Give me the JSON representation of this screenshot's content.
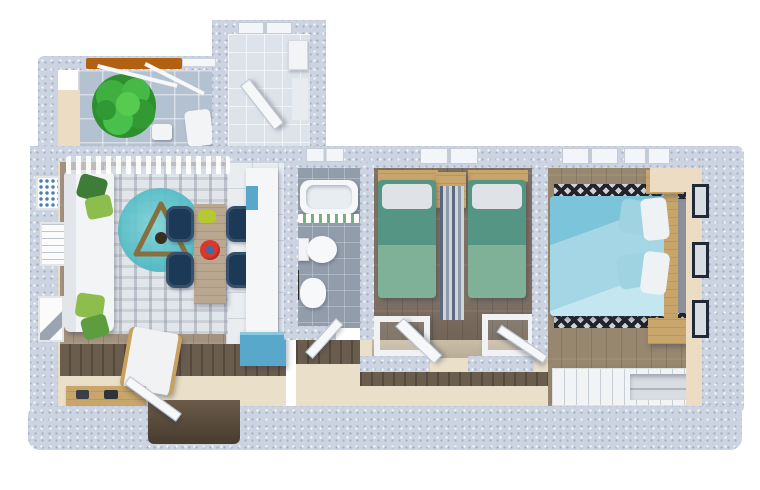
{
  "scene": {
    "type": "3d-floor-plan-render",
    "view": "top-down cutaway",
    "text_labels": [],
    "counts": {
      "dining_chairs": 4,
      "twin_beds": 2,
      "living_wall_frames": 3,
      "master_wall_frames": 3,
      "master_nightstands": 2,
      "desks": 2,
      "balcony_trees": 1
    }
  },
  "palette": {
    "wall_outer": "#ccd4e1",
    "wall_face": "#eddcc4",
    "balcony_tile": "#b4c1d1",
    "tile_light": "#dde3ea",
    "tile_kitchen": "#e9edf0",
    "tile_bath": "#929dab",
    "wood_living": "#a3927e",
    "wood_dark": "#7e7164",
    "wood_master": "#97876f",
    "wood_band": "#6b5d4e",
    "wood_furniture": "#c8a56a",
    "hall_floor": "#eadfc8",
    "rug_base": "#e2e5e9",
    "rug_round_teal": "#54bdc6",
    "rug_master": "#8d9197",
    "zigzag_dark": "#21252b",
    "sofa_white": "#f3f4f5",
    "pillow": "#dfe3e8",
    "pillow_green_dark": "#3e7d37",
    "pillow_green_light": "#8cbd4d",
    "bed_green": "#549683",
    "bed_green_light": "#7fb199",
    "bed_blue": "#a4d6e6",
    "bed_blue_deep": "#7cc4da",
    "chair_navy": "#1c3a58",
    "counter_blue": "#58a8cc",
    "rail_orange": "#b26012",
    "tree_green": "#3faf3f",
    "accent_red": "#d8382e",
    "frame_navy": "#1e2a38",
    "void_dark": "#473c2f"
  },
  "rooms": [
    {
      "id": "balcony",
      "objects": [
        "potted-tree",
        "tile-floor",
        "orange-rail",
        "pergola-beams",
        "outdoor-chair"
      ]
    },
    {
      "id": "utility-room",
      "objects": [
        "window",
        "open-door",
        "washer-unit",
        "shelf",
        "tile-floor"
      ]
    },
    {
      "id": "living-dining-kitchen",
      "objects": [
        "sofa",
        "green-cushions",
        "area-rug",
        "round-teal-rug",
        "triangle-decor",
        "wall-frames",
        "dining-table",
        "dining-chairs",
        "red-plate",
        "green-dish",
        "lounge-chair",
        "kitchen-counter",
        "blue-cabinet",
        "shoe-bench",
        "shoes",
        "curtained-window",
        "entry-door",
        "entry-opening"
      ]
    },
    {
      "id": "bathroom",
      "objects": [
        "bathtub",
        "shower-curtain",
        "toilet",
        "bidet",
        "towel-rail",
        "window",
        "door"
      ]
    },
    {
      "id": "bedroom-twin",
      "objects": [
        "single-bed-left",
        "single-bed-right",
        "headboards",
        "nightstand",
        "striped-runner",
        "desk-left",
        "desk-right",
        "window",
        "open-door"
      ]
    },
    {
      "id": "bedroom-master",
      "objects": [
        "double-bed",
        "blue-pillows",
        "white-pillows",
        "headboard",
        "nightstand-top",
        "nightstand-bottom",
        "zigzag-rug",
        "wardrobe",
        "wall-frames",
        "windows"
      ]
    },
    {
      "id": "hallway",
      "objects": [
        "wood-wall-band",
        "beige-floor",
        "door-to-master"
      ]
    }
  ]
}
